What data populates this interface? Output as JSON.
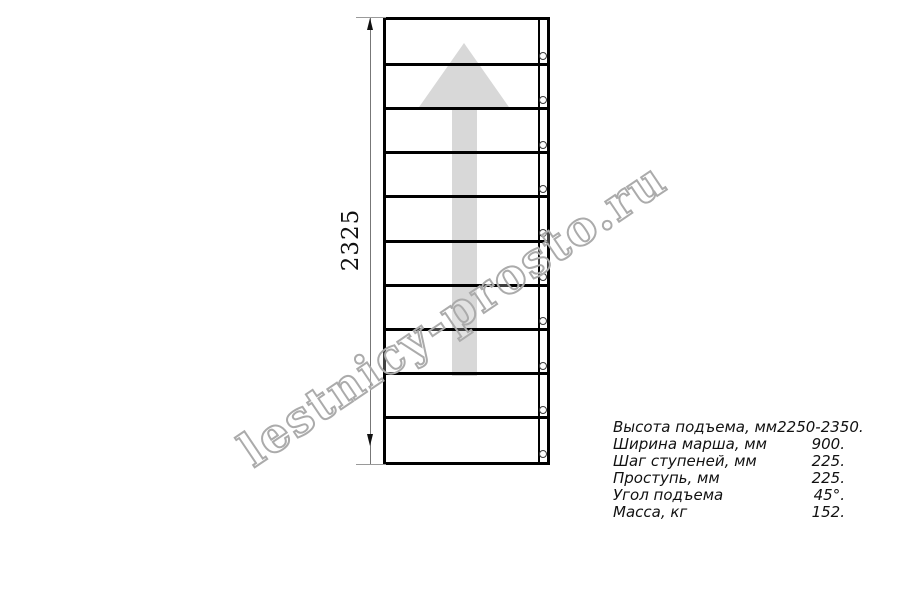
{
  "watermark": {
    "text": "lestnicy-prosto.ru"
  },
  "drawing": {
    "height_dimension": "2325",
    "steps_count": 10
  },
  "specs": {
    "rows": [
      {
        "label": "Высота подъема, мм",
        "value": "2250-2350."
      },
      {
        "label": "Ширина марша, мм",
        "value": "900."
      },
      {
        "label": "Шаг ступеней, мм",
        "value": "225."
      },
      {
        "label": "Проступь, мм",
        "value": "225."
      },
      {
        "label": "Угол подъема",
        "value": "45°."
      },
      {
        "label": "Масса, кг",
        "value": "152."
      }
    ]
  },
  "colors": {
    "line": "#000000",
    "direction_arrow_fill": "#d8d8d8",
    "dimension_line": "#777777",
    "watermark_stroke": "#ababab"
  }
}
